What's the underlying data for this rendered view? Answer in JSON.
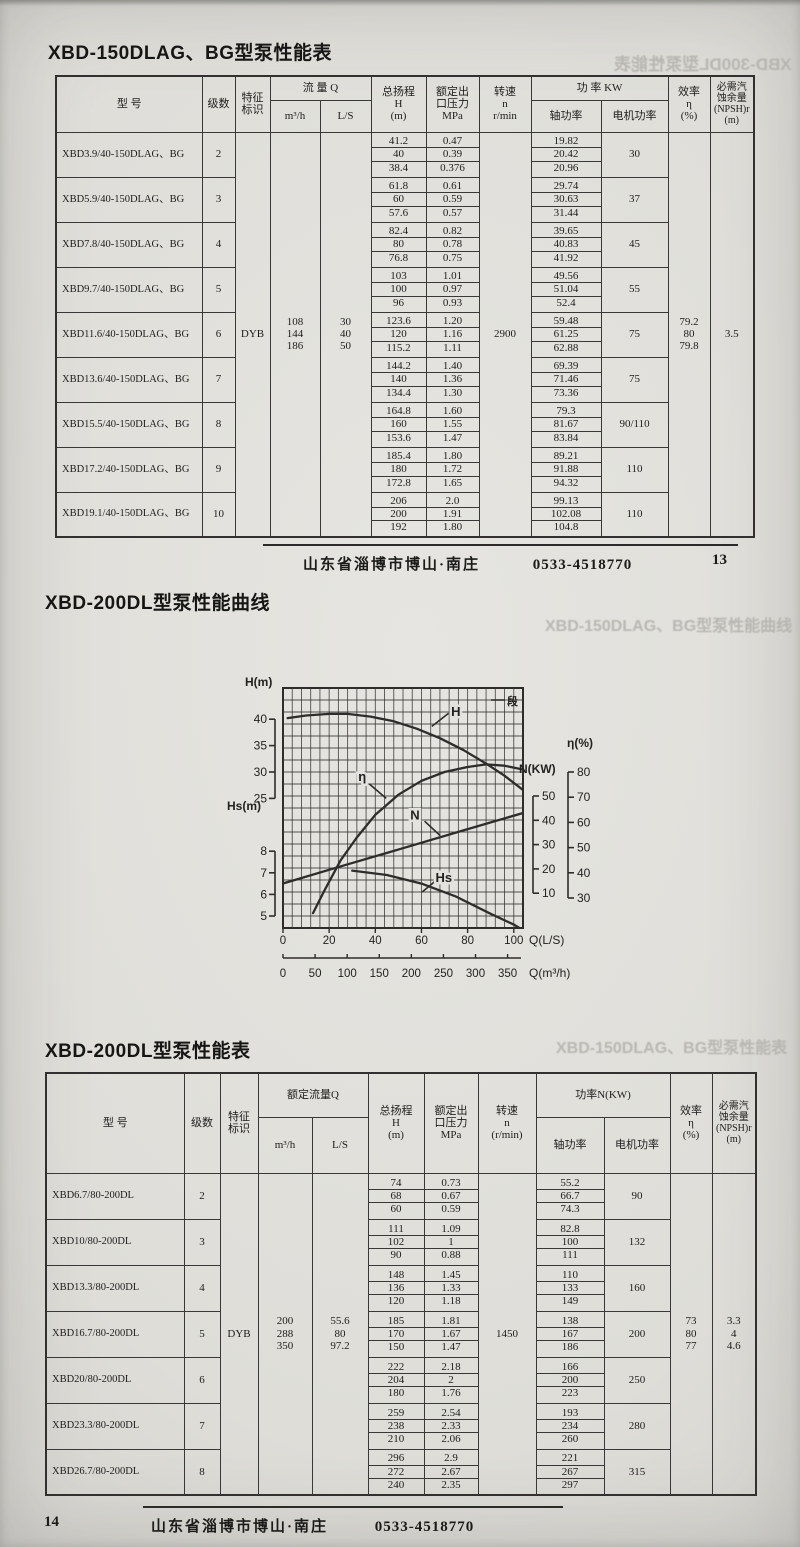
{
  "section1": {
    "title": "XBD-150DLAG、BG型泵性能表",
    "footer": {
      "address": "山东省淄博市博山·南庄",
      "phone": "0533-4518770",
      "page": "13"
    },
    "table": {
      "headers": {
        "model": "型  号",
        "stages": "级数",
        "mark": "特征\n标识",
        "flow": "流 量 Q",
        "m3h": "m³/h",
        "ls": "L/S",
        "head": "总扬程\nH\n(m)",
        "pressure": "额定出\n口压力\nMPa",
        "speed": "转速\nn\nr/min",
        "power": "功 率 KW",
        "shaft": "轴功率",
        "motor": "电机功率",
        "eff": "效率\nη\n(%)",
        "npsh": "必需汽\n蚀余量\n(NPSH)r\n(m)"
      },
      "shared": {
        "mark": "DYB",
        "flow_m3h": [
          "108",
          "144",
          "186"
        ],
        "flow_ls": [
          "30",
          "40",
          "50"
        ],
        "speed": "2900",
        "eff": [
          "79.2",
          "80",
          "79.8"
        ],
        "npsh": [
          "3.5"
        ]
      },
      "rows": [
        {
          "model": "XBD3.9/40-150DLAG、BG",
          "stages": "2",
          "head": [
            "41.2",
            "40",
            "38.4"
          ],
          "mpa": [
            "0.47",
            "0.39",
            "0.376"
          ],
          "shaft": [
            "19.82",
            "20.42",
            "20.96"
          ],
          "motor": "30"
        },
        {
          "model": "XBD5.9/40-150DLAG、BG",
          "stages": "3",
          "head": [
            "61.8",
            "60",
            "57.6"
          ],
          "mpa": [
            "0.61",
            "0.59",
            "0.57"
          ],
          "shaft": [
            "29.74",
            "30.63",
            "31.44"
          ],
          "motor": "37"
        },
        {
          "model": "XBD7.8/40-150DLAG、BG",
          "stages": "4",
          "head": [
            "82.4",
            "80",
            "76.8"
          ],
          "mpa": [
            "0.82",
            "0.78",
            "0.75"
          ],
          "shaft": [
            "39.65",
            "40.83",
            "41.92"
          ],
          "motor": "45"
        },
        {
          "model": "XBD9.7/40-150DLAG、BG",
          "stages": "5",
          "head": [
            "103",
            "100",
            "96"
          ],
          "mpa": [
            "1.01",
            "0.97",
            "0.93"
          ],
          "shaft": [
            "49.56",
            "51.04",
            "52.4"
          ],
          "motor": "55"
        },
        {
          "model": "XBD11.6/40-150DLAG、BG",
          "stages": "6",
          "head": [
            "123.6",
            "120",
            "115.2"
          ],
          "mpa": [
            "1.20",
            "1.16",
            "1.11"
          ],
          "shaft": [
            "59.48",
            "61.25",
            "62.88"
          ],
          "motor": "75"
        },
        {
          "model": "XBD13.6/40-150DLAG、BG",
          "stages": "7",
          "head": [
            "144.2",
            "140",
            "134.4"
          ],
          "mpa": [
            "1.40",
            "1.36",
            "1.30"
          ],
          "shaft": [
            "69.39",
            "71.46",
            "73.36"
          ],
          "motor": "75"
        },
        {
          "model": "XBD15.5/40-150DLAG、BG",
          "stages": "8",
          "head": [
            "164.8",
            "160",
            "153.6"
          ],
          "mpa": [
            "1.60",
            "1.55",
            "1.47"
          ],
          "shaft": [
            "79.3",
            "81.67",
            "83.84"
          ],
          "motor": "90/110"
        },
        {
          "model": "XBD17.2/40-150DLAG、BG",
          "stages": "9",
          "head": [
            "185.4",
            "180",
            "172.8"
          ],
          "mpa": [
            "1.80",
            "1.72",
            "1.65"
          ],
          "shaft": [
            "89.21",
            "91.88",
            "94.32"
          ],
          "motor": "110"
        },
        {
          "model": "XBD19.1/40-150DLAG、BG",
          "stages": "10",
          "head": [
            "206",
            "200",
            "192"
          ],
          "mpa": [
            "2.0",
            "1.91",
            "1.80"
          ],
          "shaft": [
            "99.13",
            "102.08",
            "104.8"
          ],
          "motor": "110"
        }
      ]
    }
  },
  "chart_section": {
    "title": "XBD-200DL型泵性能曲线"
  },
  "chart_data": {
    "type": "line",
    "title": "XBD-200DL型泵性能曲线",
    "grid": {
      "cols": 26,
      "rows": 20
    },
    "x_axis": {
      "label": "Q(L/S)",
      "ticks": [
        0,
        20,
        40,
        60,
        80,
        100
      ],
      "max": 104
    },
    "x_axis2": {
      "label": "Q(m³/h)",
      "ticks": [
        0,
        50,
        100,
        150,
        200,
        250,
        300,
        350
      ],
      "max": 374
    },
    "axes": {
      "H": {
        "label": "H(m)",
        "ticks": [
          40,
          35,
          30,
          25
        ],
        "frac_top": 0.13,
        "frac_bottom": 0.46,
        "side": "left"
      },
      "Hs": {
        "label": "Hs(m)",
        "ticks": [
          8,
          7,
          6,
          5
        ],
        "frac_top": 0.68,
        "frac_bottom": 0.95,
        "side": "left"
      },
      "N": {
        "label": "N(KW)",
        "ticks": [
          50,
          40,
          30,
          20,
          10
        ],
        "frac_top": 0.45,
        "frac_bottom": 0.855,
        "side": "right"
      },
      "eta": {
        "label": "η(%)",
        "ticks": [
          80,
          70,
          60,
          50,
          40,
          30
        ],
        "frac_top": 0.35,
        "frac_bottom": 0.875,
        "side": "right"
      }
    },
    "series": [
      {
        "name": "H",
        "axis": "H",
        "label_pos": [
          0.72,
          0.08
        ],
        "leader": [
          [
            0.62,
            0.16
          ],
          [
            0.69,
            0.105
          ]
        ],
        "points": [
          [
            2,
            40.2
          ],
          [
            10,
            40.7
          ],
          [
            20,
            41
          ],
          [
            28,
            41
          ],
          [
            38,
            40.5
          ],
          [
            48,
            39.6
          ],
          [
            58,
            38.2
          ],
          [
            68,
            36.4
          ],
          [
            78,
            34.2
          ],
          [
            88,
            31.6
          ],
          [
            96,
            29.3
          ],
          [
            104,
            26.6
          ]
        ]
      },
      {
        "name": "η",
        "axis": "eta",
        "label_pos": [
          0.33,
          0.35
        ],
        "leader": [
          [
            0.36,
            0.4
          ],
          [
            0.43,
            0.46
          ]
        ],
        "points": [
          [
            13,
            24
          ],
          [
            18,
            33
          ],
          [
            25,
            45
          ],
          [
            32,
            54
          ],
          [
            40,
            63
          ],
          [
            50,
            71
          ],
          [
            60,
            76.5
          ],
          [
            70,
            80
          ],
          [
            80,
            82
          ],
          [
            88,
            83
          ],
          [
            96,
            82.5
          ],
          [
            104,
            81
          ]
        ]
      },
      {
        "name": "N",
        "axis": "N",
        "label_pos": [
          0.55,
          0.51
        ],
        "leader": [
          [
            0.59,
            0.555
          ],
          [
            0.655,
            0.615
          ]
        ],
        "points": [
          [
            0,
            14
          ],
          [
            26,
            21.3
          ],
          [
            52,
            28.5
          ],
          [
            78,
            35.8
          ],
          [
            104,
            43
          ]
        ]
      },
      {
        "name": "Hs",
        "axis": "Hs",
        "label_pos": [
          0.67,
          0.77
        ],
        "leader": [
          [
            0.64,
            0.8
          ],
          [
            0.58,
            0.85
          ]
        ],
        "points": [
          [
            30,
            7.1
          ],
          [
            45,
            6.9
          ],
          [
            60,
            6.5
          ],
          [
            75,
            5.9
          ],
          [
            90,
            5.1
          ],
          [
            100,
            4.6
          ],
          [
            104,
            4.35
          ]
        ]
      }
    ],
    "corner_glyph": "段"
  },
  "section2": {
    "title": "XBD-200DL型泵性能表",
    "footer": {
      "page": "14",
      "address": "山东省淄博市博山·南庄",
      "phone": "0533-4518770"
    },
    "table": {
      "headers": {
        "model": "型  号",
        "stages": "级数",
        "mark": "特征\n标识",
        "flow": "额定流量Q",
        "m3h": "m³/h",
        "ls": "L/S",
        "head": "总扬程\nH\n(m)",
        "pressure": "额定出\n口压力\nMPa",
        "speed": "转速\nn\n(r/min)",
        "power": "功率N(KW)",
        "shaft": "轴功率",
        "motor": "电机功率",
        "eff": "效率\nη\n(%)",
        "npsh": "必需汽\n蚀余量\n(NPSH)r\n(m)"
      },
      "shared": {
        "mark": "DYB",
        "flow_m3h": [
          "200",
          "288",
          "350"
        ],
        "flow_ls": [
          "55.6",
          "80",
          "97.2"
        ],
        "speed": "1450",
        "eff": [
          "73",
          "80",
          "77"
        ],
        "npsh": [
          "3.3",
          "4",
          "4.6"
        ]
      },
      "rows": [
        {
          "model": "XBD6.7/80-200DL",
          "stages": "2",
          "head": [
            "74",
            "68",
            "60"
          ],
          "mpa": [
            "0.73",
            "0.67",
            "0.59"
          ],
          "shaft": [
            "55.2",
            "66.7",
            "74.3"
          ],
          "motor": "90"
        },
        {
          "model": "XBD10/80-200DL",
          "stages": "3",
          "head": [
            "111",
            "102",
            "90"
          ],
          "mpa": [
            "1.09",
            "1",
            "0.88"
          ],
          "shaft": [
            "82.8",
            "100",
            "111"
          ],
          "motor": "132"
        },
        {
          "model": "XBD13.3/80-200DL",
          "stages": "4",
          "head": [
            "148",
            "136",
            "120"
          ],
          "mpa": [
            "1.45",
            "1.33",
            "1.18"
          ],
          "shaft": [
            "110",
            "133",
            "149"
          ],
          "motor": "160"
        },
        {
          "model": "XBD16.7/80-200DL",
          "stages": "5",
          "head": [
            "185",
            "170",
            "150"
          ],
          "mpa": [
            "1.81",
            "1.67",
            "1.47"
          ],
          "shaft": [
            "138",
            "167",
            "186"
          ],
          "motor": "200"
        },
        {
          "model": "XBD20/80-200DL",
          "stages": "6",
          "head": [
            "222",
            "204",
            "180"
          ],
          "mpa": [
            "2.18",
            "2",
            "1.76"
          ],
          "shaft": [
            "166",
            "200",
            "223"
          ],
          "motor": "250"
        },
        {
          "model": "XBD23.3/80-200DL",
          "stages": "7",
          "head": [
            "259",
            "238",
            "210"
          ],
          "mpa": [
            "2.54",
            "2.33",
            "2.06"
          ],
          "shaft": [
            "193",
            "234",
            "260"
          ],
          "motor": "280"
        },
        {
          "model": "XBD26.7/80-200DL",
          "stages": "8",
          "head": [
            "296",
            "272",
            "240"
          ],
          "mpa": [
            "2.9",
            "2.67",
            "2.35"
          ],
          "shaft": [
            "221",
            "267",
            "297"
          ],
          "motor": "315"
        }
      ]
    }
  },
  "artifacts": {
    "ghost_top": "XBD-300DL型泵性能表",
    "ghost_mid": "XBD-150DLAG、BG型泵性能曲线",
    "ghost_bottom": "XBD-150DLAG、BG型泵性能表"
  }
}
